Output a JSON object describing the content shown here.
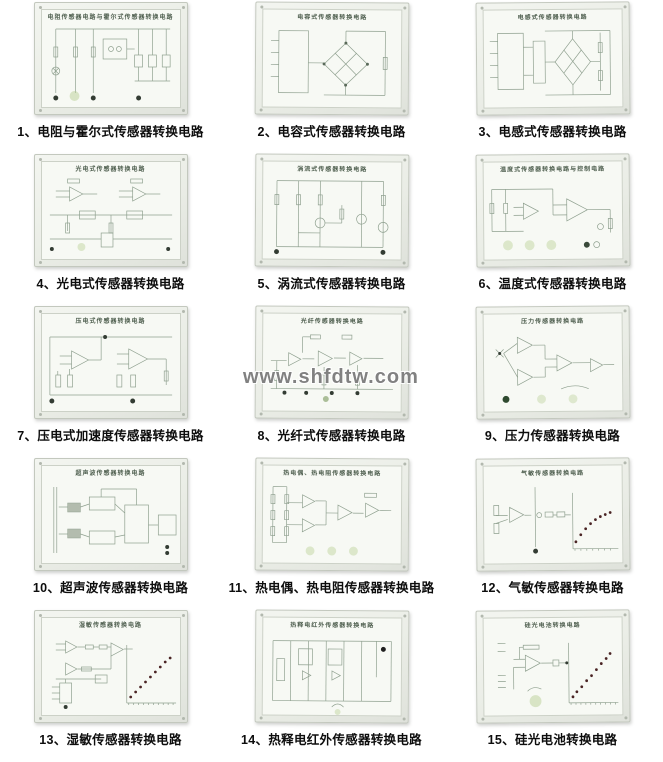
{
  "page": {
    "background": "#ffffff",
    "watermark": "www.shfdtw.com"
  },
  "style": {
    "caption_color": "#0d0d0d",
    "board_line_color": "#8fa08f",
    "board_background": "#f7f9f4",
    "frame_color": "#e9ebe6",
    "terminal_green": "rgba(186,208,150,0.5)",
    "graph_dot_color": "#4a2424"
  },
  "panels": [
    {
      "caption": "1、电阻与霍尔式传感器转换电路",
      "board_title": "电阻传感器电路与霍尔式传感器转换电路",
      "schematic": "hall"
    },
    {
      "caption": "2、电容式传感器转换电路",
      "board_title": "电容式传感器转换电路",
      "schematic": "capacitive"
    },
    {
      "caption": "3、电感式传感器转换电路",
      "board_title": "电感式传感器转换电路",
      "schematic": "inductive"
    },
    {
      "caption": "4、光电式传感器转换电路",
      "board_title": "光电式传感器转换电路",
      "schematic": "photoelectric"
    },
    {
      "caption": "5、涡流式传感器转换电路",
      "board_title": "涡流式传感器转换电路",
      "schematic": "eddy"
    },
    {
      "caption": "6、温度式传感器转换电路",
      "board_title": "温度式传感器转换电路与控制电路",
      "schematic": "temperature"
    },
    {
      "caption": "7、压电式加速度传感器转换电路",
      "board_title": "压电式传感器转换电路",
      "schematic": "piezo"
    },
    {
      "caption": "8、光纤式传感器转换电路",
      "board_title": "光纤传感器转换电路",
      "schematic": "fiber"
    },
    {
      "caption": "9、压力传感器转换电路",
      "board_title": "压力传感器转换电路",
      "schematic": "pressure"
    },
    {
      "caption": "10、超声波传感器转换电路",
      "board_title": "超声波传感器转换电路",
      "schematic": "ultrasonic"
    },
    {
      "caption": "11、热电偶、热电阻传感器转换电路",
      "board_title": "热电偶、热电阻传感器转换电路",
      "schematic": "thermocouple"
    },
    {
      "caption": "12、气敏传感器转换电路",
      "board_title": "气敏传感器转换电路",
      "schematic": "gas"
    },
    {
      "caption": "13、湿敏传感器转换电路",
      "board_title": "湿敏传感器转换电路",
      "schematic": "humidity"
    },
    {
      "caption": "14、热释电红外传感器转换电路",
      "board_title": "热释电红外传感器转换电路",
      "schematic": "pyroelectric"
    },
    {
      "caption": "15、硅光电池转换电路",
      "board_title": "硅光电池转换电路",
      "schematic": "silicon"
    }
  ]
}
